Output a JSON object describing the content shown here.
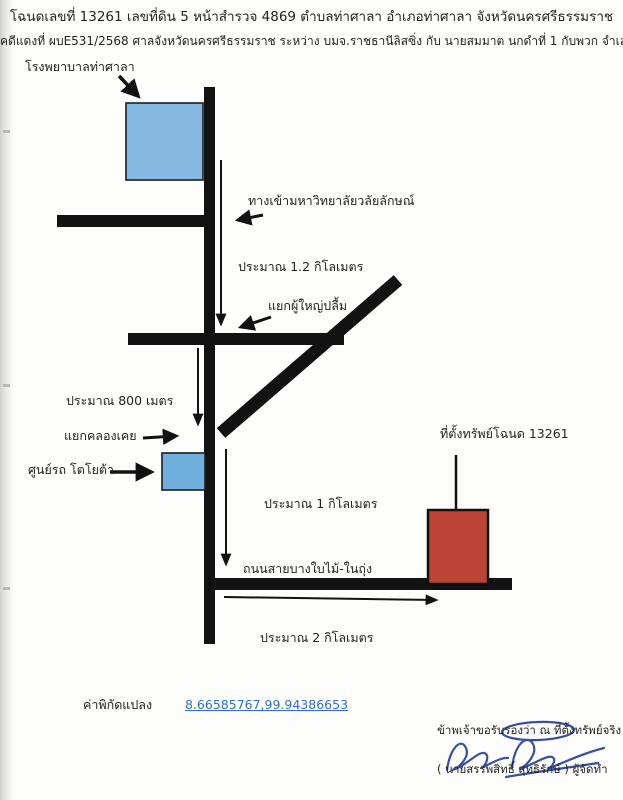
{
  "document": {
    "title_line": "โฉนดเลขที่  13261 เลขที่ดิน 5 หน้าสำรวจ 4869  ตำบลท่าศาลา อำเภอท่าศาลา จังหวัดนครศรีธรรมราช",
    "case_line": "คดีแดงที่ ผบE531/2568 ศาลจังหวัดนครศรีธรรมราช  ระหว่าง บมจ.ราชธานีลิสซิ่ง กับ นายสมมาต นกดำที่ 1 กับพวก จำเลย"
  },
  "map": {
    "labels": {
      "hospital": "โรงพยาบาลท่าศาลา",
      "university_entrance": "ทางเข้ามหาวิทยาลัยวลัยลักษณ์",
      "distance_1_2km": "ประมาณ 1.2 กิโลเมตร",
      "phuyai_pluem_junction": "แยกผู้ใหญ่ปลื้ม",
      "distance_800m": "ประมาณ 800 เมตร",
      "khlong_koei_junction": "แยกคลองเคย",
      "toyota_center": "ศูนย์รถ โตโยต้า",
      "property_location": "ที่ตั้งทรัพย์โฉนด 13261",
      "distance_1km": "ประมาณ 1 กิโลเมตร",
      "road_name": "ถนนสายบางใบไม้-ในถุ่ง",
      "distance_2km": "ประมาณ 2 กิโลเมตร"
    },
    "colors": {
      "road": "#121212",
      "hospital_block": "#85b9e2",
      "toyota_block": "#6fb0dd",
      "property_block": "#bc4437",
      "signature_ink": "#3b4f9e",
      "link": "#2e6fcb"
    }
  },
  "footer": {
    "coordinates_label": "ค่าพิกัดแปลง",
    "coordinates_value": "8.66585767,99.94386653",
    "certification": "ข้าพเจ้าขอรับรองว่า ณ ที่ตั้งทรัพย์จริง",
    "preparer": "( นายสรรพสิทธิ์  สุทธิรักษ์ ) ผู้จัดทำ"
  }
}
